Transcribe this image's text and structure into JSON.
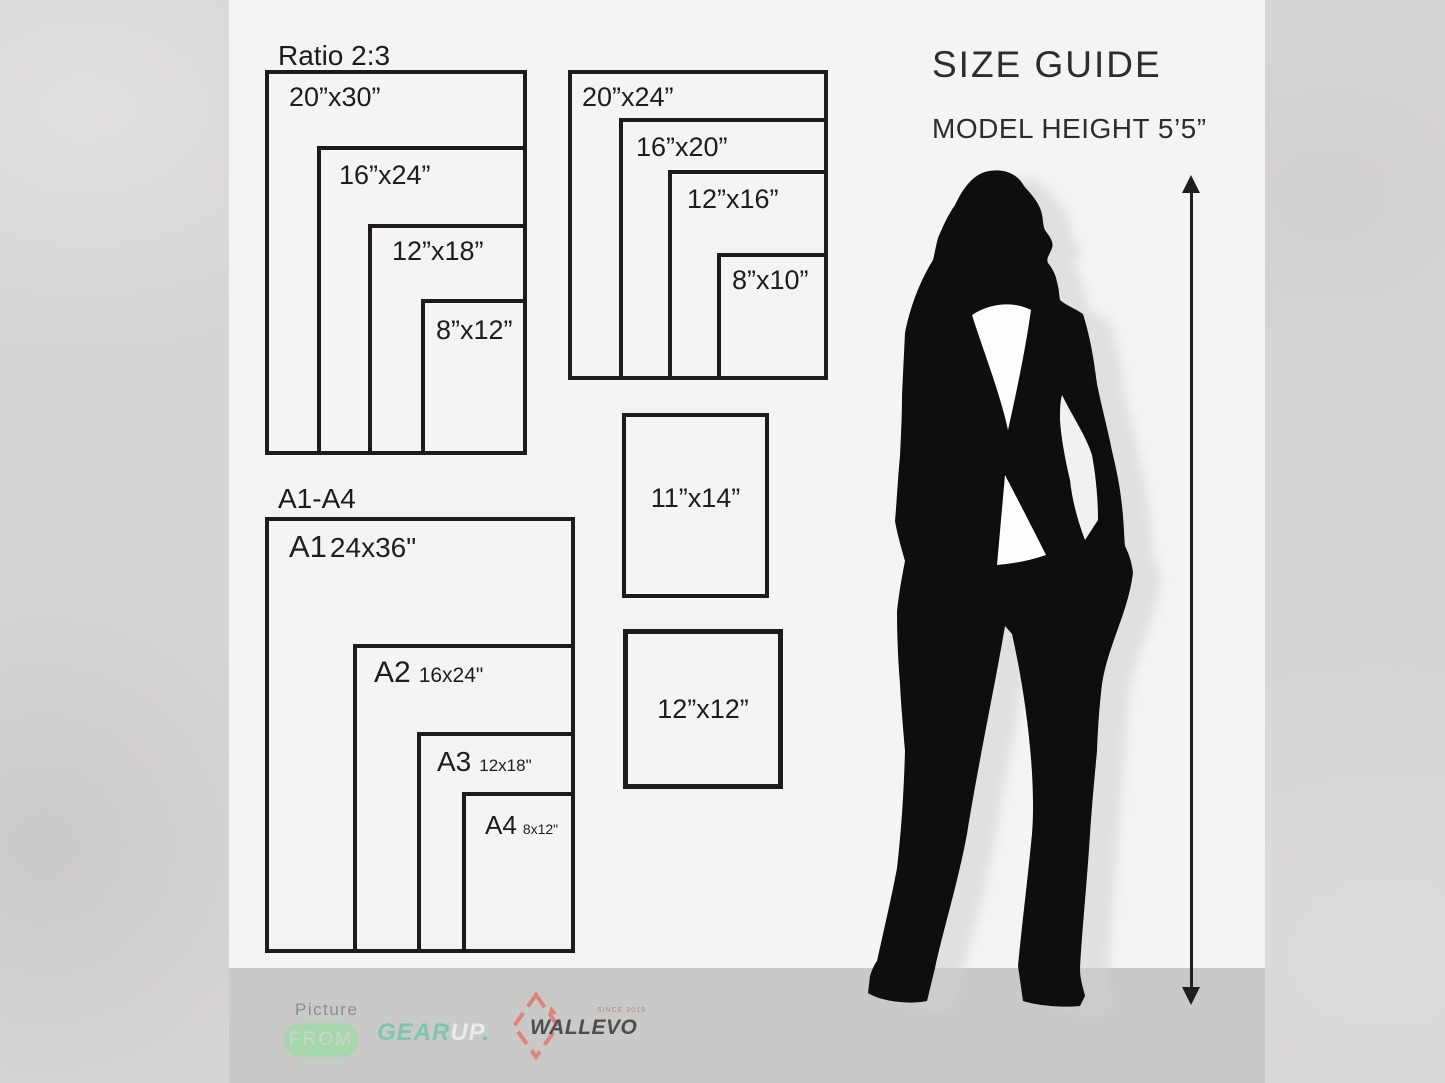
{
  "header": {
    "title": "SIZE GUIDE",
    "model_height": "MODEL HEIGHT 5’5”"
  },
  "ratio_group": {
    "heading": "Ratio 2:3",
    "sizes": [
      "20”x30”",
      "16”x24”",
      "12”x18”",
      "8”x12”"
    ]
  },
  "second_group": {
    "sizes": [
      "20”x24”",
      "16”x20”",
      "12”x16”",
      "8”x10”"
    ]
  },
  "a_group": {
    "heading": "A1-A4",
    "items": [
      {
        "code": "A1",
        "size": "24x36\""
      },
      {
        "code": "A2",
        "size": "16x24\""
      },
      {
        "code": "A3",
        "size": "12x18\""
      },
      {
        "code": "A4",
        "size": "8x12\""
      }
    ]
  },
  "singles": {
    "size_11x14": "11”x14”",
    "size_12x12": "12”x12”"
  },
  "footer": {
    "picture": "Picture",
    "from": "FROM",
    "gear": "GEAR",
    "up": "UP",
    "dot": ".",
    "wallevo": "WALLEVO",
    "since": "SINCE 2019"
  },
  "colors": {
    "pill_green": "#a6d7ad",
    "gear_teal": "#7dc6ac",
    "wallevo_red": "#df837a",
    "silhouette_black": "#0e0e0e",
    "panel_white": "#f5f4f2",
    "footer_gray": "#c9c9c8"
  }
}
